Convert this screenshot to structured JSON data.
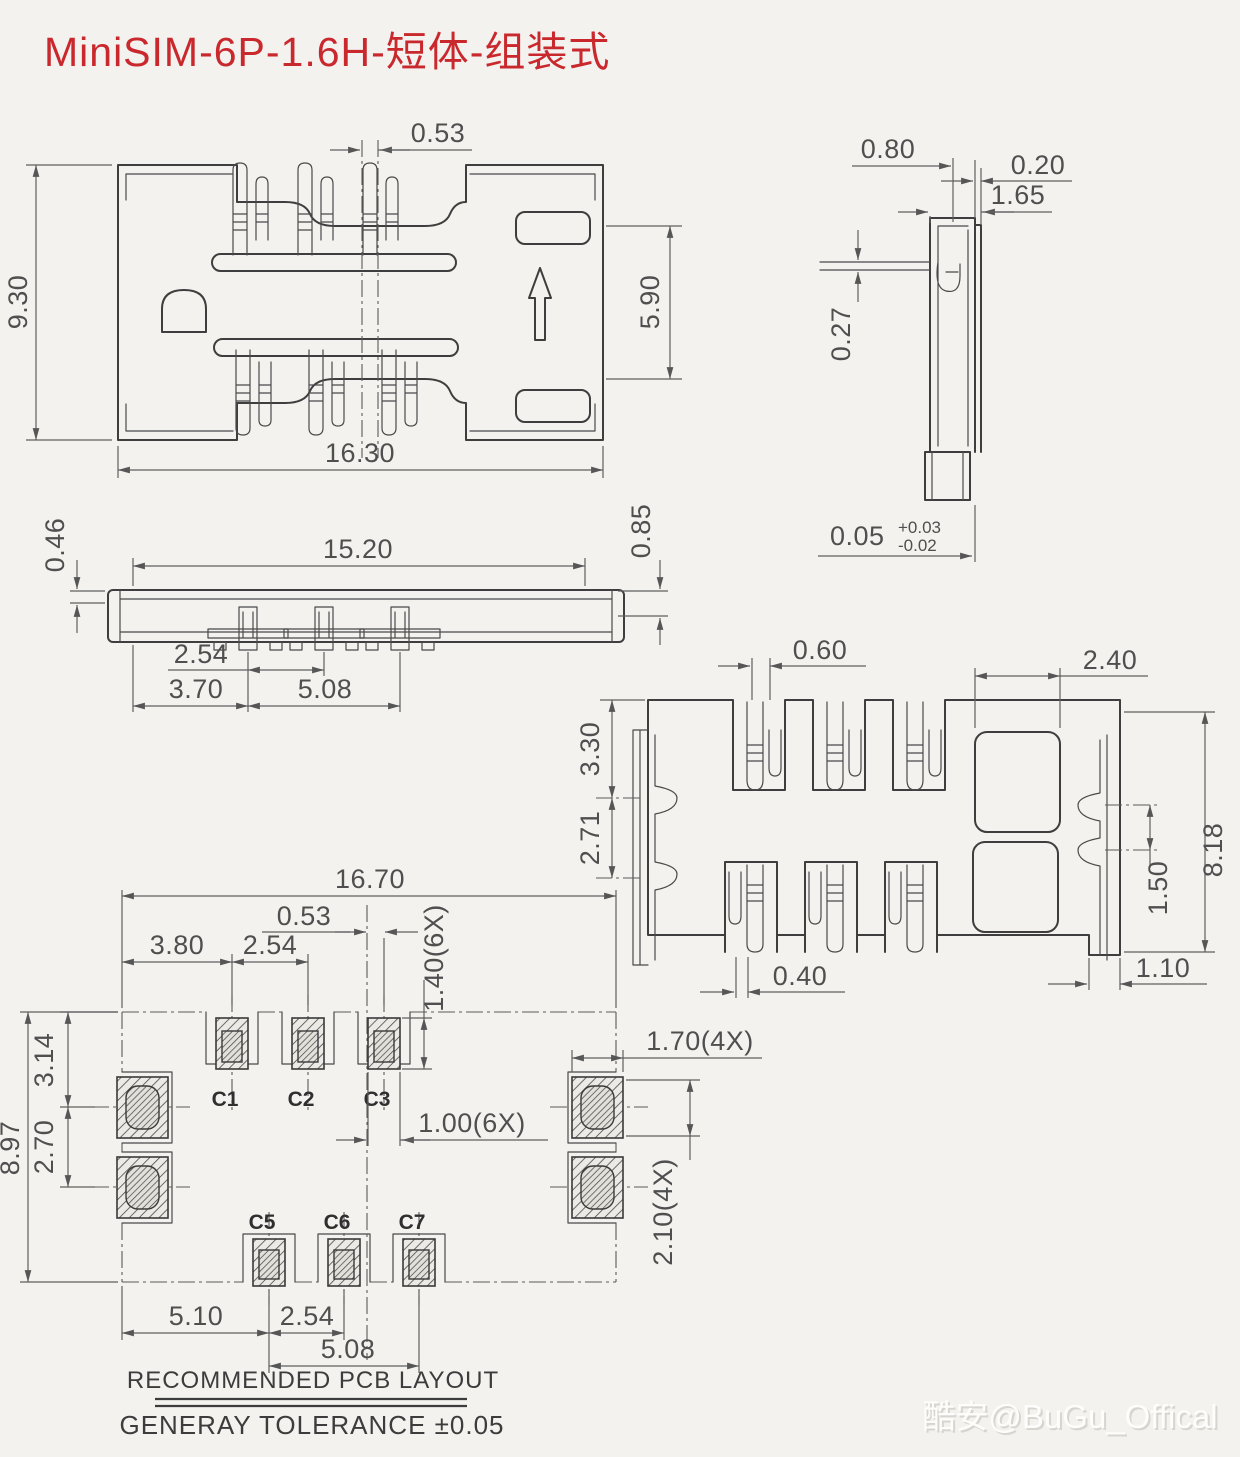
{
  "title": "MiniSIM-6P-1.6H-短体-组装式",
  "colors": {
    "title_red": "#c9282d",
    "line": "#3e3e3e",
    "dim_text": "#4f4f4f",
    "background": "#f3f2ef"
  },
  "top_view": {
    "dim_center_offset": "0.53",
    "dim_body_height": "9.30",
    "dim_body_width": "16.30",
    "dim_opening_height": "5.90"
  },
  "side_view": {
    "dim_tab_width": "0.80",
    "dim_wall": "0.20",
    "dim_depth": "1.65",
    "dim_lead_thickness": "0.27",
    "dim_standoff": "0.05",
    "dim_standoff_tol_plus": "+0.03",
    "dim_standoff_tol_minus": "-0.02"
  },
  "front_view": {
    "dim_cover": "0.46",
    "dim_width": "15.20",
    "dim_height": "0.85",
    "dim_pin_pitch": "2.54",
    "dim_edge_to_pin": "3.70",
    "dim_pin_span": "5.08"
  },
  "bottom_view": {
    "dim_pin_offset": "0.60",
    "dim_window_width": "2.40",
    "dim_edge_to_bump": "3.30",
    "dim_bump_pitch": "2.71",
    "dim_bump_span": "1.50",
    "dim_height": "8.18",
    "dim_pin_tail": "0.40",
    "dim_side_rail": "1.10"
  },
  "pcb_layout": {
    "dim_total_width": "16.70",
    "dim_center_offset": "0.53",
    "dim_edge_to_pad": "3.80",
    "dim_pad_pitch_top": "2.54",
    "dim_pad_height": "1.40(6X)",
    "dim_edge_to_side_pad": "3.14",
    "dim_side_pad_pitch": "2.70",
    "dim_total_height": "8.97",
    "dim_side_pad_width": "1.70(4X)",
    "dim_pad_width": "1.00(6X)",
    "dim_side_pad_height": "2.10(4X)",
    "dim_edge_to_first_pad": "5.10",
    "dim_pad_pitch_bottom": "2.54",
    "dim_pad_span_bottom": "5.08",
    "pad_labels": {
      "c1": "C1",
      "c2": "C2",
      "c3": "C3",
      "c5": "C5",
      "c6": "C6",
      "c7": "C7"
    }
  },
  "footer": {
    "pcb_note": "RECOMMENDED PCB LAYOUT",
    "tolerance_note": "GENERAY TOLERANCE ±0.05"
  },
  "watermark": "酷安@BuGu_Offical"
}
